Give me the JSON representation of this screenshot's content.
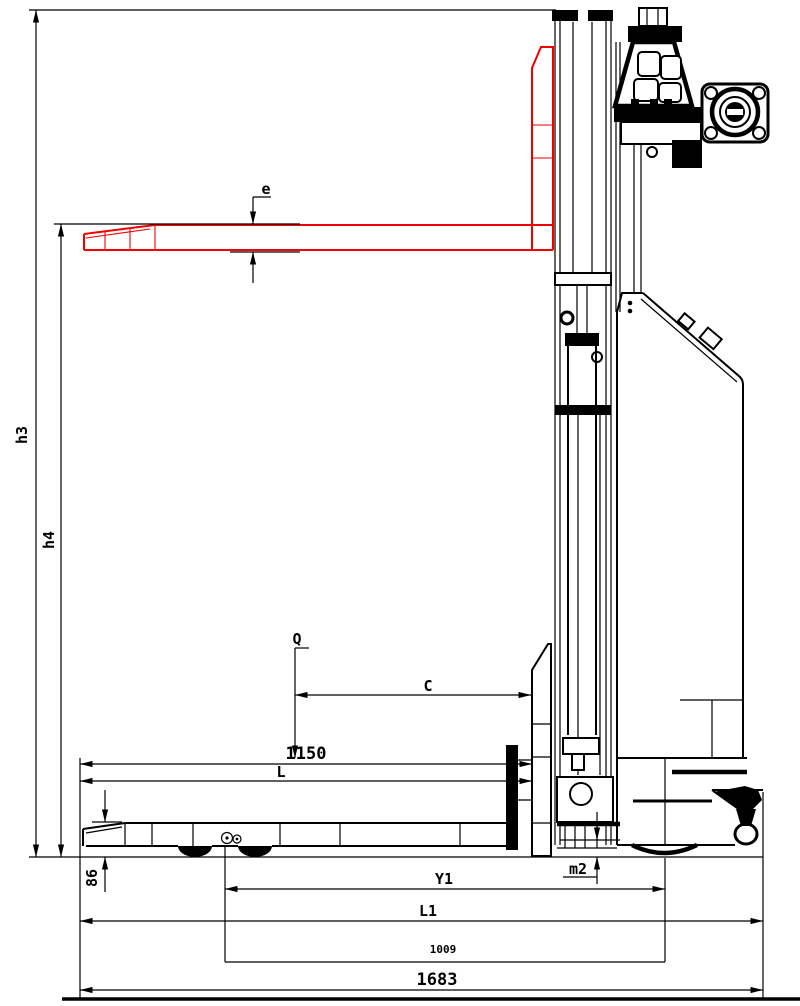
{
  "drawing": {
    "type": "engineering-diagram",
    "subject": "electric stacker forklift side elevation with dimension lines",
    "colors": {
      "line": "#000000",
      "fork_raised": "#f10000",
      "background": "#ffffff"
    },
    "labels": {
      "h3": "h3",
      "h4": "h4",
      "e": "e",
      "q": "Q",
      "c": "C",
      "d1150": "1150",
      "l": "L",
      "d86": "86",
      "y1": "Y1",
      "m2": "m2",
      "l1": "L1",
      "d1009": "1009",
      "d1683": "1683"
    },
    "dimensions": [
      {
        "label": "h3",
        "meaning": "lift height to mast top",
        "orientation": "vertical"
      },
      {
        "label": "h4",
        "meaning": "height of raised fork",
        "orientation": "vertical"
      },
      {
        "label": "e",
        "meaning": "fork thickness",
        "orientation": "vertical"
      },
      {
        "label": "Q",
        "meaning": "load capacity reference point",
        "orientation": "vertical"
      },
      {
        "label": "C",
        "meaning": "load centre distance",
        "orientation": "horizontal"
      },
      {
        "label": "1150",
        "meaning": "fork length",
        "orientation": "horizontal"
      },
      {
        "label": "L",
        "meaning": "fork length symbol",
        "orientation": "horizontal"
      },
      {
        "label": "86",
        "meaning": "lowered fork height",
        "orientation": "vertical"
      },
      {
        "label": "Y1",
        "meaning": "wheelbase symbol",
        "orientation": "horizontal"
      },
      {
        "label": "m2",
        "meaning": "ground clearance",
        "orientation": "vertical"
      },
      {
        "label": "L1",
        "meaning": "overall length symbol",
        "orientation": "horizontal"
      },
      {
        "label": "1009",
        "meaning": "wheelbase value",
        "orientation": "horizontal"
      },
      {
        "label": "1683",
        "meaning": "overall length value",
        "orientation": "horizontal"
      }
    ]
  }
}
